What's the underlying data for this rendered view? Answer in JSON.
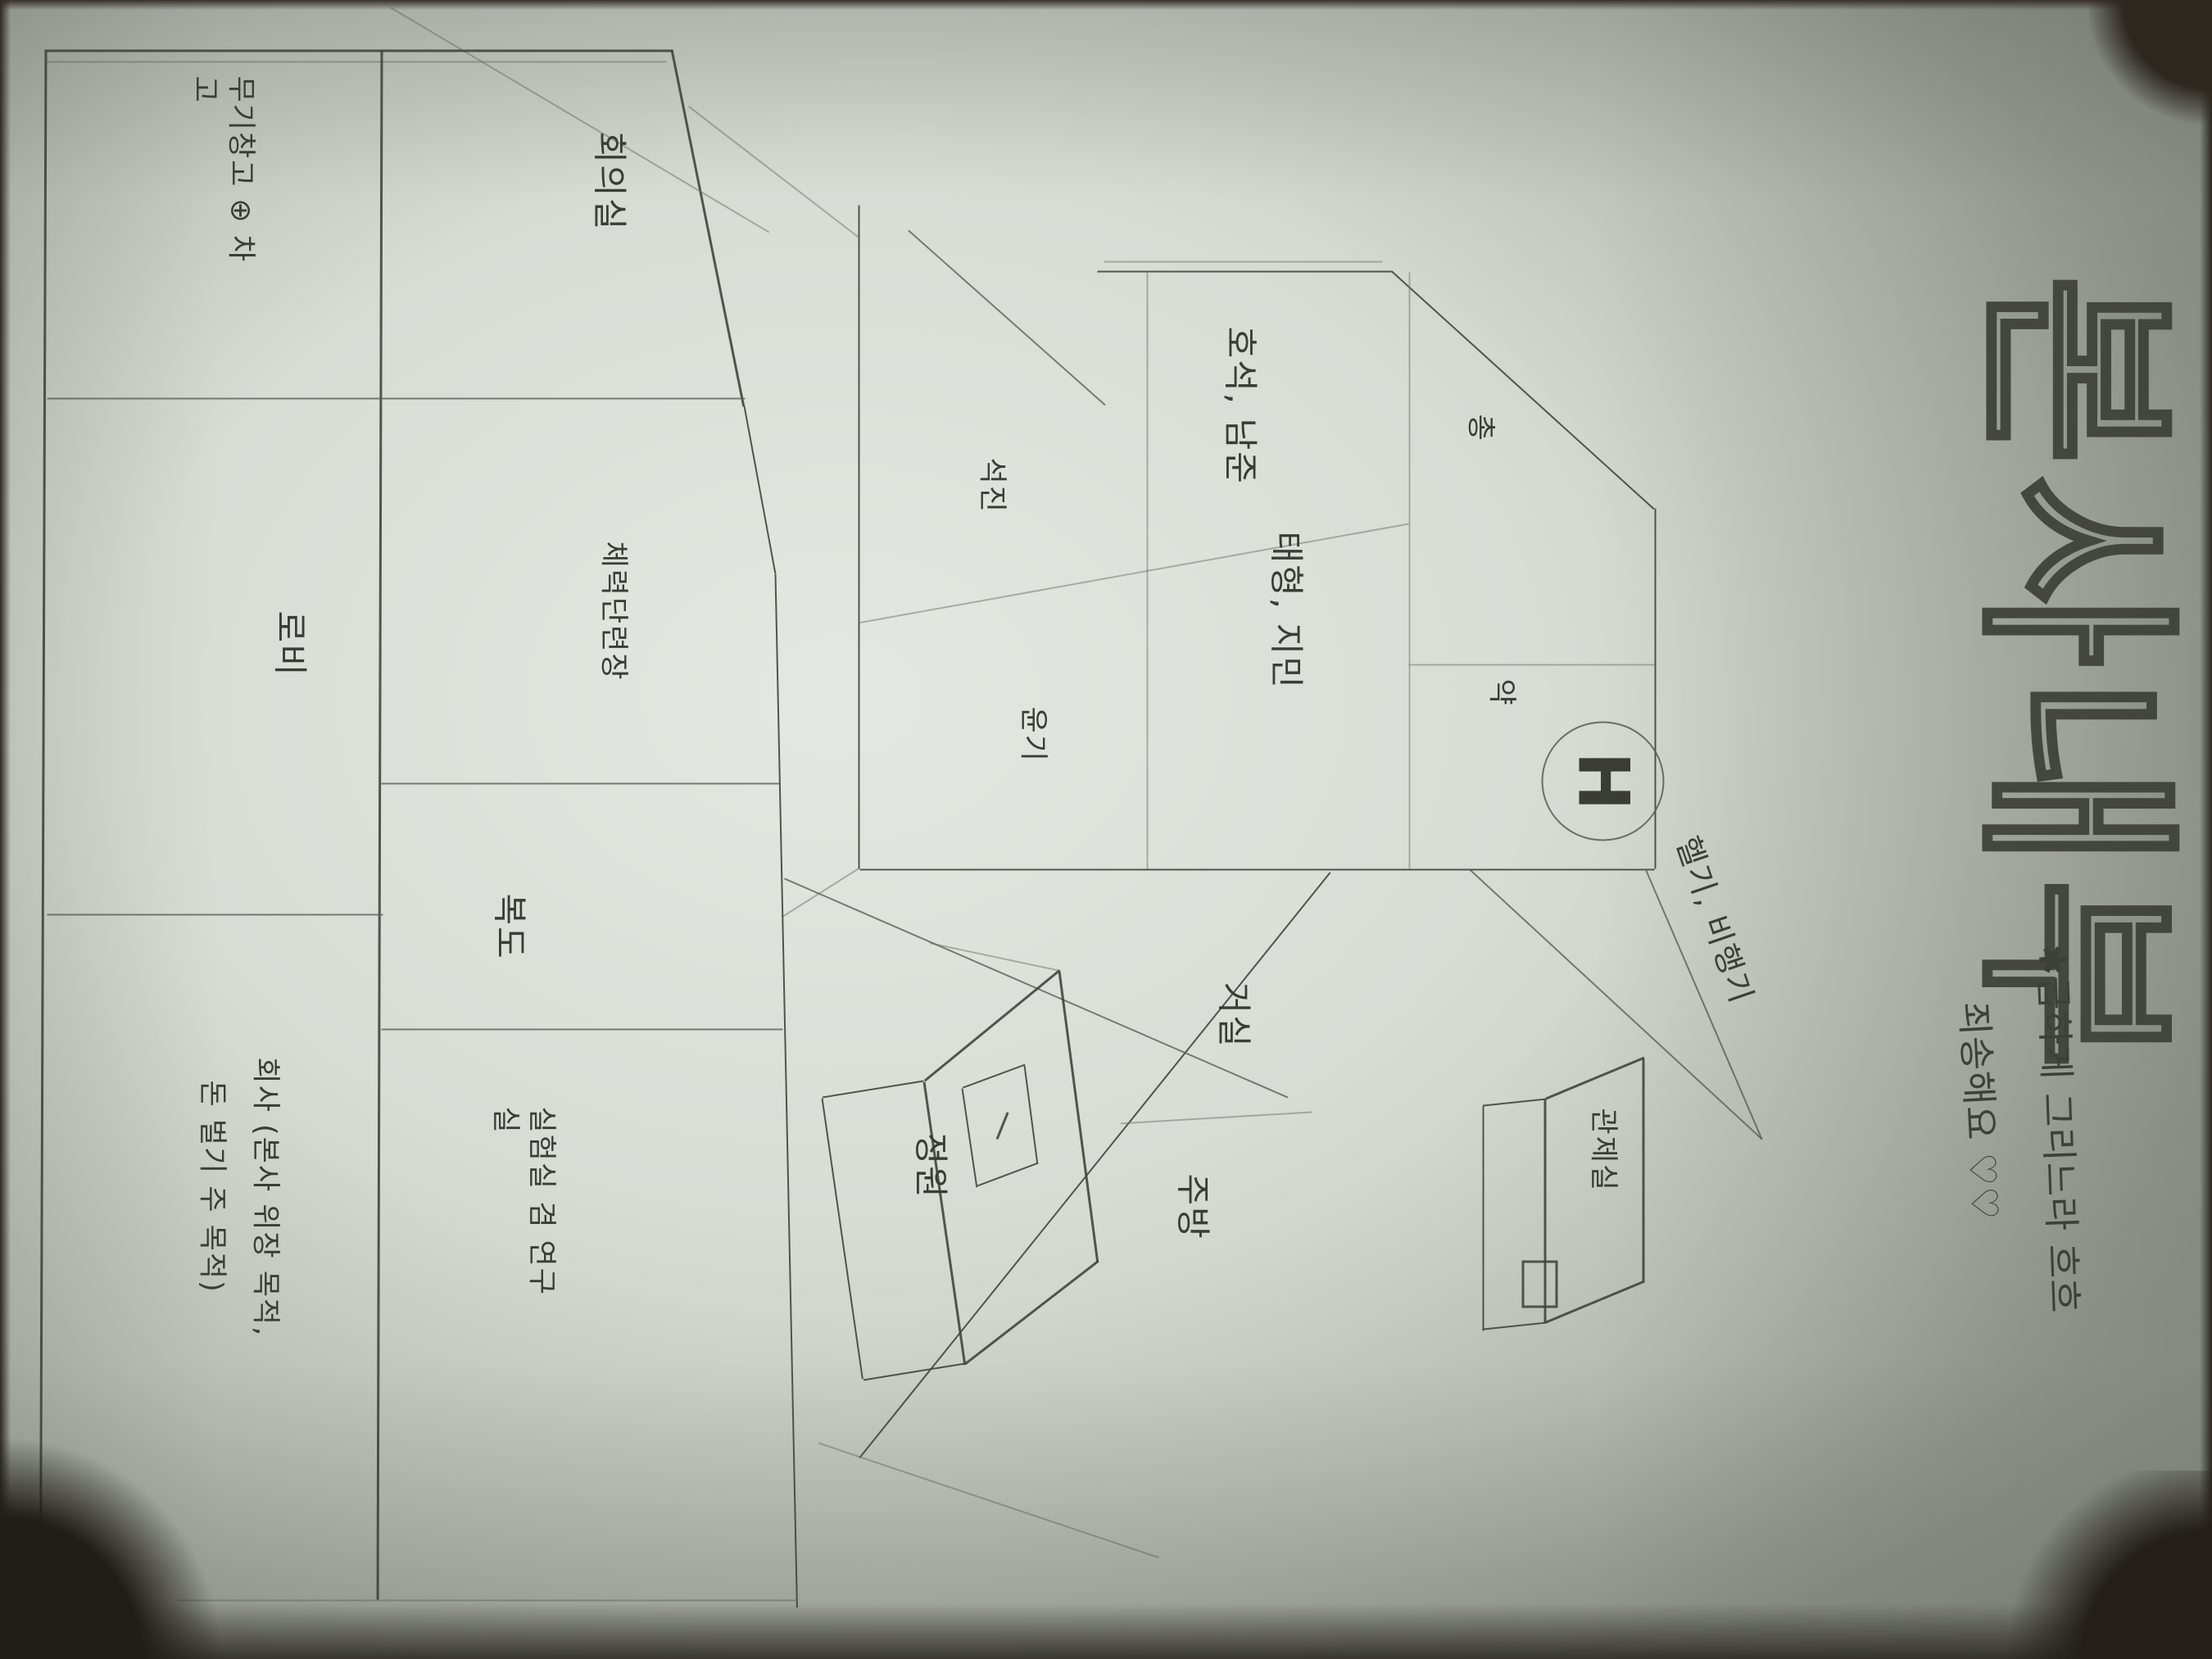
{
  "title": "본사내부",
  "note": {
    "line1": "✱급하게 그리느라 흐흐",
    "line2": "죄송해요 ♡♡"
  },
  "upper_floor": {
    "rooms": {
      "gun": "총",
      "medicine": "약",
      "hoseok_namjoon": "호석, 남준",
      "taehyung_jimin": "태형, 지민",
      "seokjin": "석진",
      "yoongi": "윤기"
    },
    "helipad": {
      "letter": "H",
      "label": "헬기, 비행기"
    }
  },
  "middle": {
    "living_room": "거실",
    "kitchen": "주방",
    "garden": "정원",
    "control_room": "관제실"
  },
  "lower_floor": {
    "meeting_room": "회의실",
    "gym": "체력단련장",
    "corridor": "복도",
    "lab": "실험실 겸 연구실",
    "armory": "무기창고 ⊕ 차고",
    "lobby": "로비",
    "company_line1": "회사 (본사 위장 목적,",
    "company_line2": "돈 벌기 주 목적)"
  }
}
